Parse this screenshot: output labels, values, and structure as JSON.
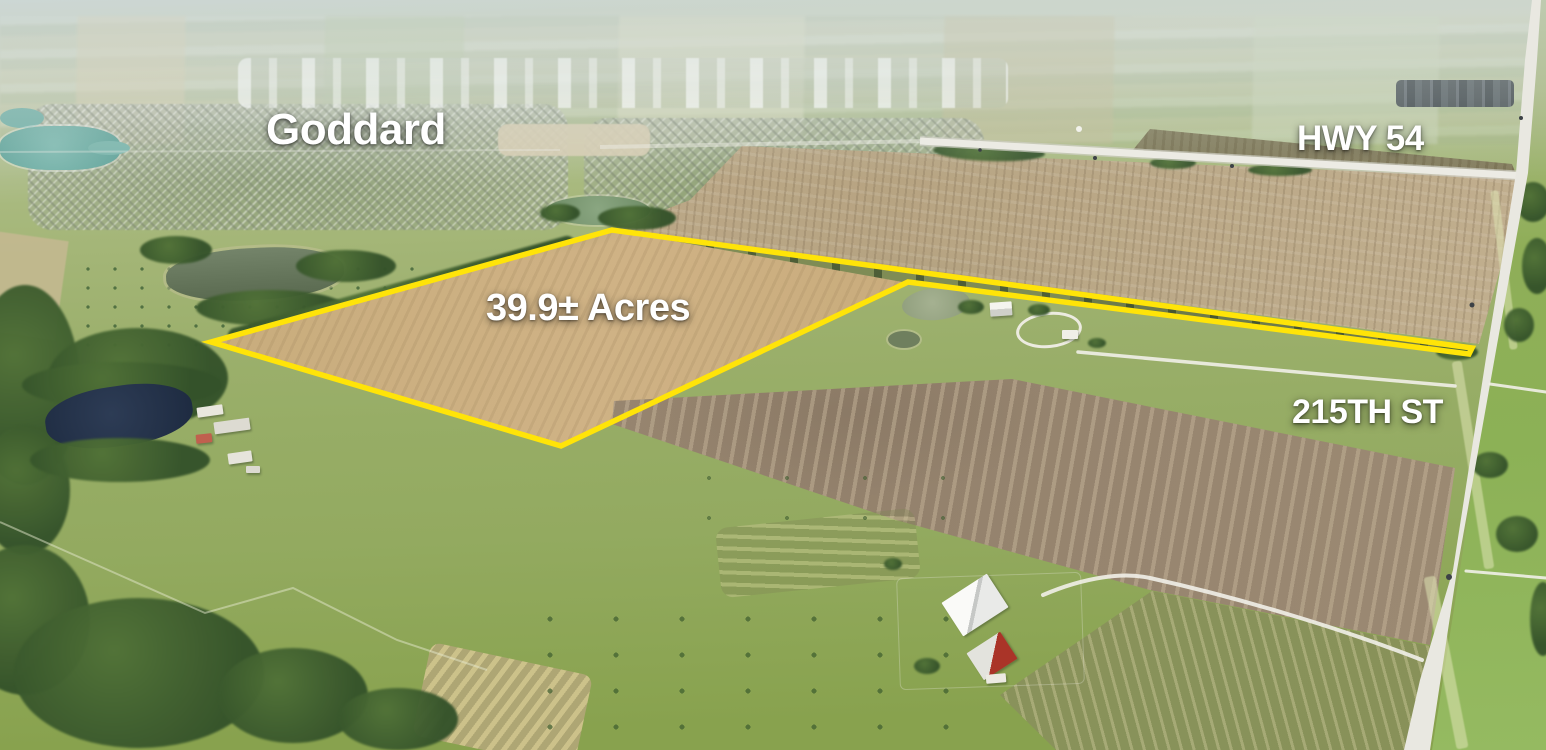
{
  "image_type": "aerial-property-listing-photo",
  "labels": {
    "city": "Goddard",
    "highway": "HWY 54",
    "street": "215TH ST",
    "acreage": "39.9± Acres"
  },
  "parcel": {
    "outline_points": "211,342 612,230 1472,348 1469,354 908,282 561,446",
    "outline_color": "#FFE408"
  },
  "colors": {
    "label_text": "#FFFFFF",
    "outline_yellow": "#FFE408",
    "wheat_stubble_field": "#C8AC79",
    "tilled_field_brown": "#9A8872",
    "pasture_green": "#97AD66",
    "pond_teal": "#6FB0A6",
    "pond_navy": "#263349",
    "road_surface": "#EBEAE4",
    "horizon_haze": "#CCD6D3"
  }
}
